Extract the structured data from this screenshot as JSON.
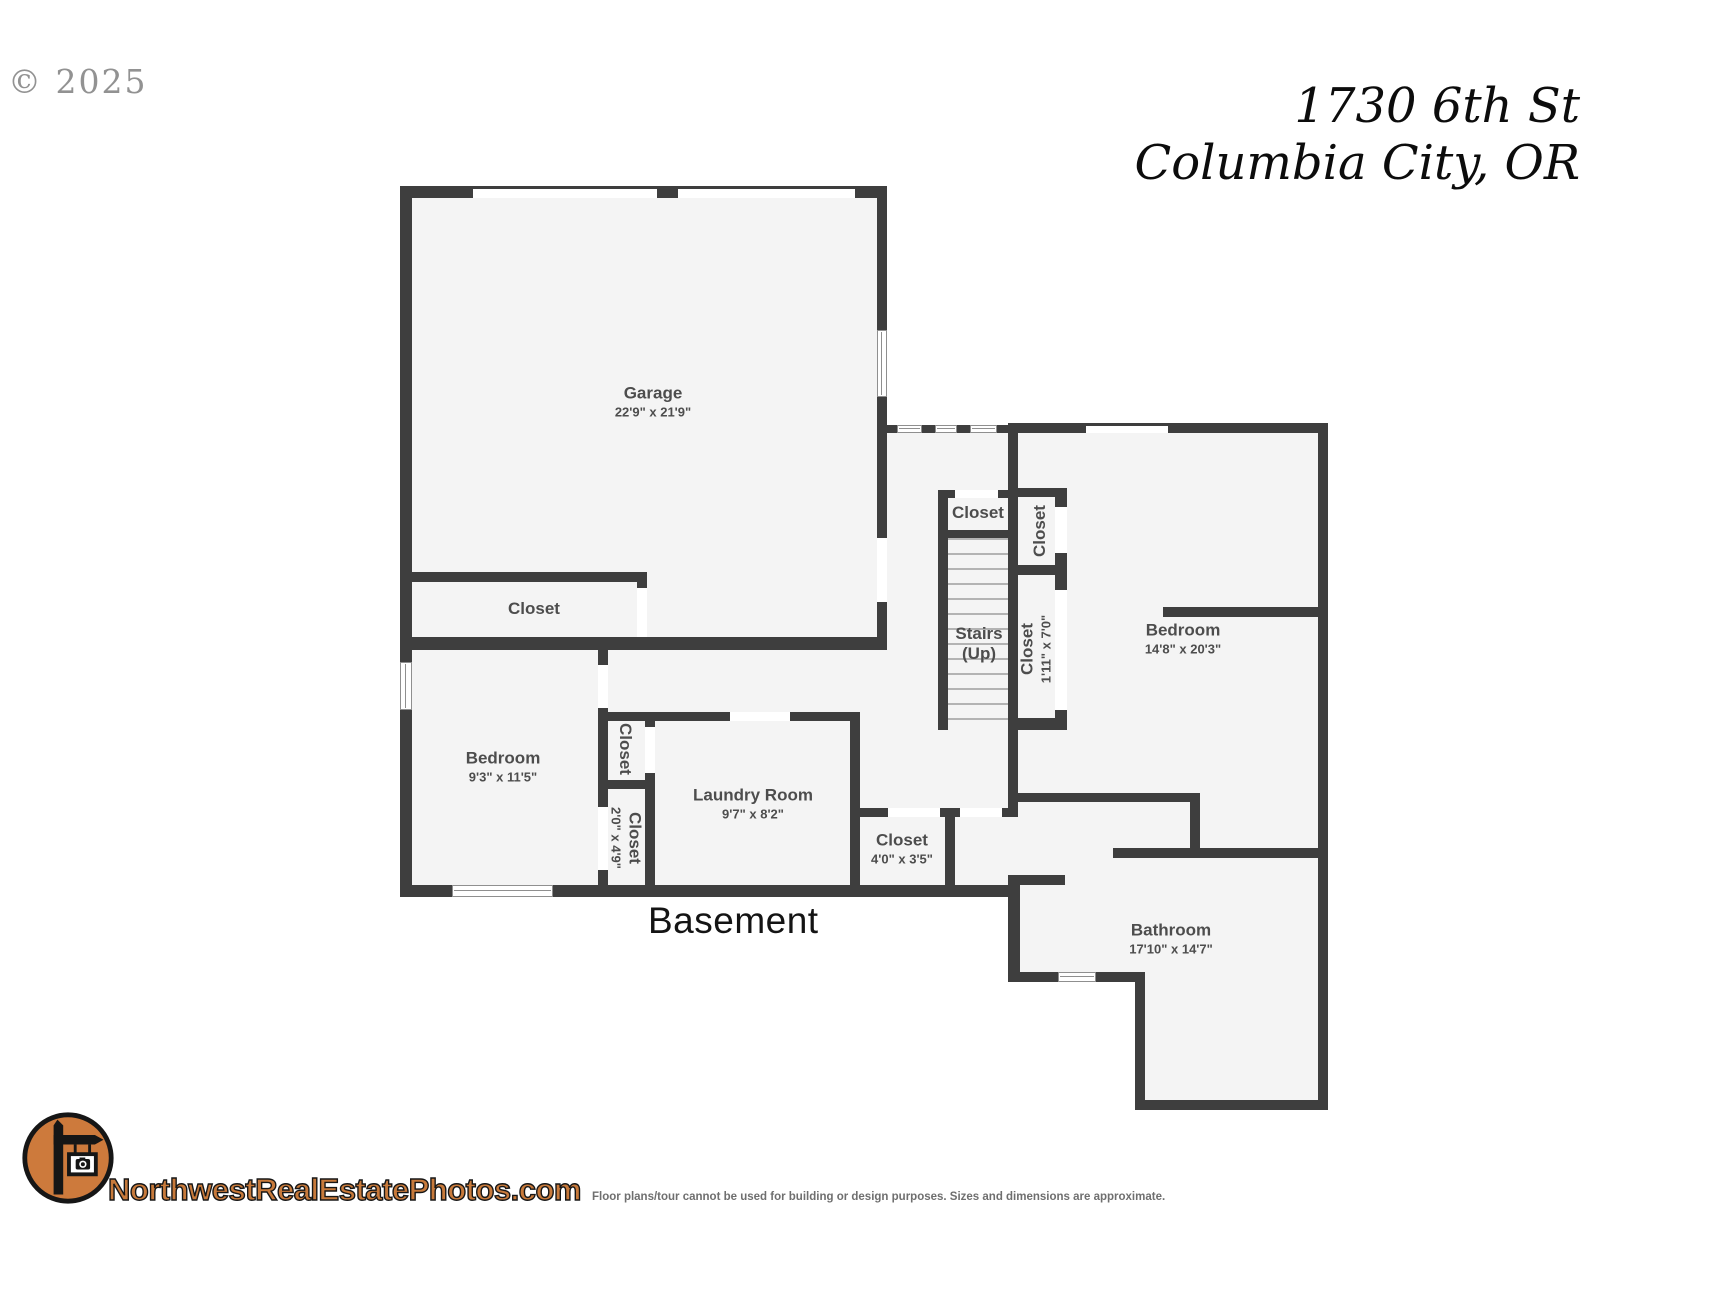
{
  "copyright": "© 2025",
  "title": {
    "line1": "1730 6th St",
    "line2": "Columbia City, OR"
  },
  "floor_label": "Basement",
  "rooms": [
    {
      "id": "garage",
      "name": "Garage",
      "dims": "22'9\" x 21'9\""
    },
    {
      "id": "closet-garage",
      "name": "Closet",
      "dims": ""
    },
    {
      "id": "bedroom-left",
      "name": "Bedroom",
      "dims": "9'3\" x 11'5\""
    },
    {
      "id": "closet-hall-upper",
      "name": "Closet",
      "dims": ""
    },
    {
      "id": "closet-hall-lower",
      "name": "Closet",
      "dims": "2'0\" x 4'9\""
    },
    {
      "id": "laundry-room",
      "name": "Laundry Room",
      "dims": "9'7\" x 8'2\""
    },
    {
      "id": "closet-mid",
      "name": "Closet",
      "dims": "4'0\" x 3'5\""
    },
    {
      "id": "closet-stairs-top",
      "name": "Closet",
      "dims": ""
    },
    {
      "id": "stairs",
      "name": "Stairs",
      "dims": "(Up)"
    },
    {
      "id": "closet-right-upper",
      "name": "Closet",
      "dims": ""
    },
    {
      "id": "closet-right-lower",
      "name": "Closet",
      "dims": "1'11\" x 7'0\""
    },
    {
      "id": "bedroom-right",
      "name": "Bedroom",
      "dims": "14'8\" x 20'3\""
    },
    {
      "id": "bathroom",
      "name": "Bathroom",
      "dims": "17'10\" x 14'7\""
    }
  ],
  "footer": {
    "brand": "NorthwestRealEstatePhotos.com",
    "disclaimer": "Floor plans/tour cannot be used for building or design purposes. Sizes and dimensions are approximate."
  },
  "colors": {
    "wall": "#3e3e3e",
    "floor": "#f4f4f4",
    "brand_orange": "#c87a3b",
    "label_gray": "#4d4d4d"
  }
}
